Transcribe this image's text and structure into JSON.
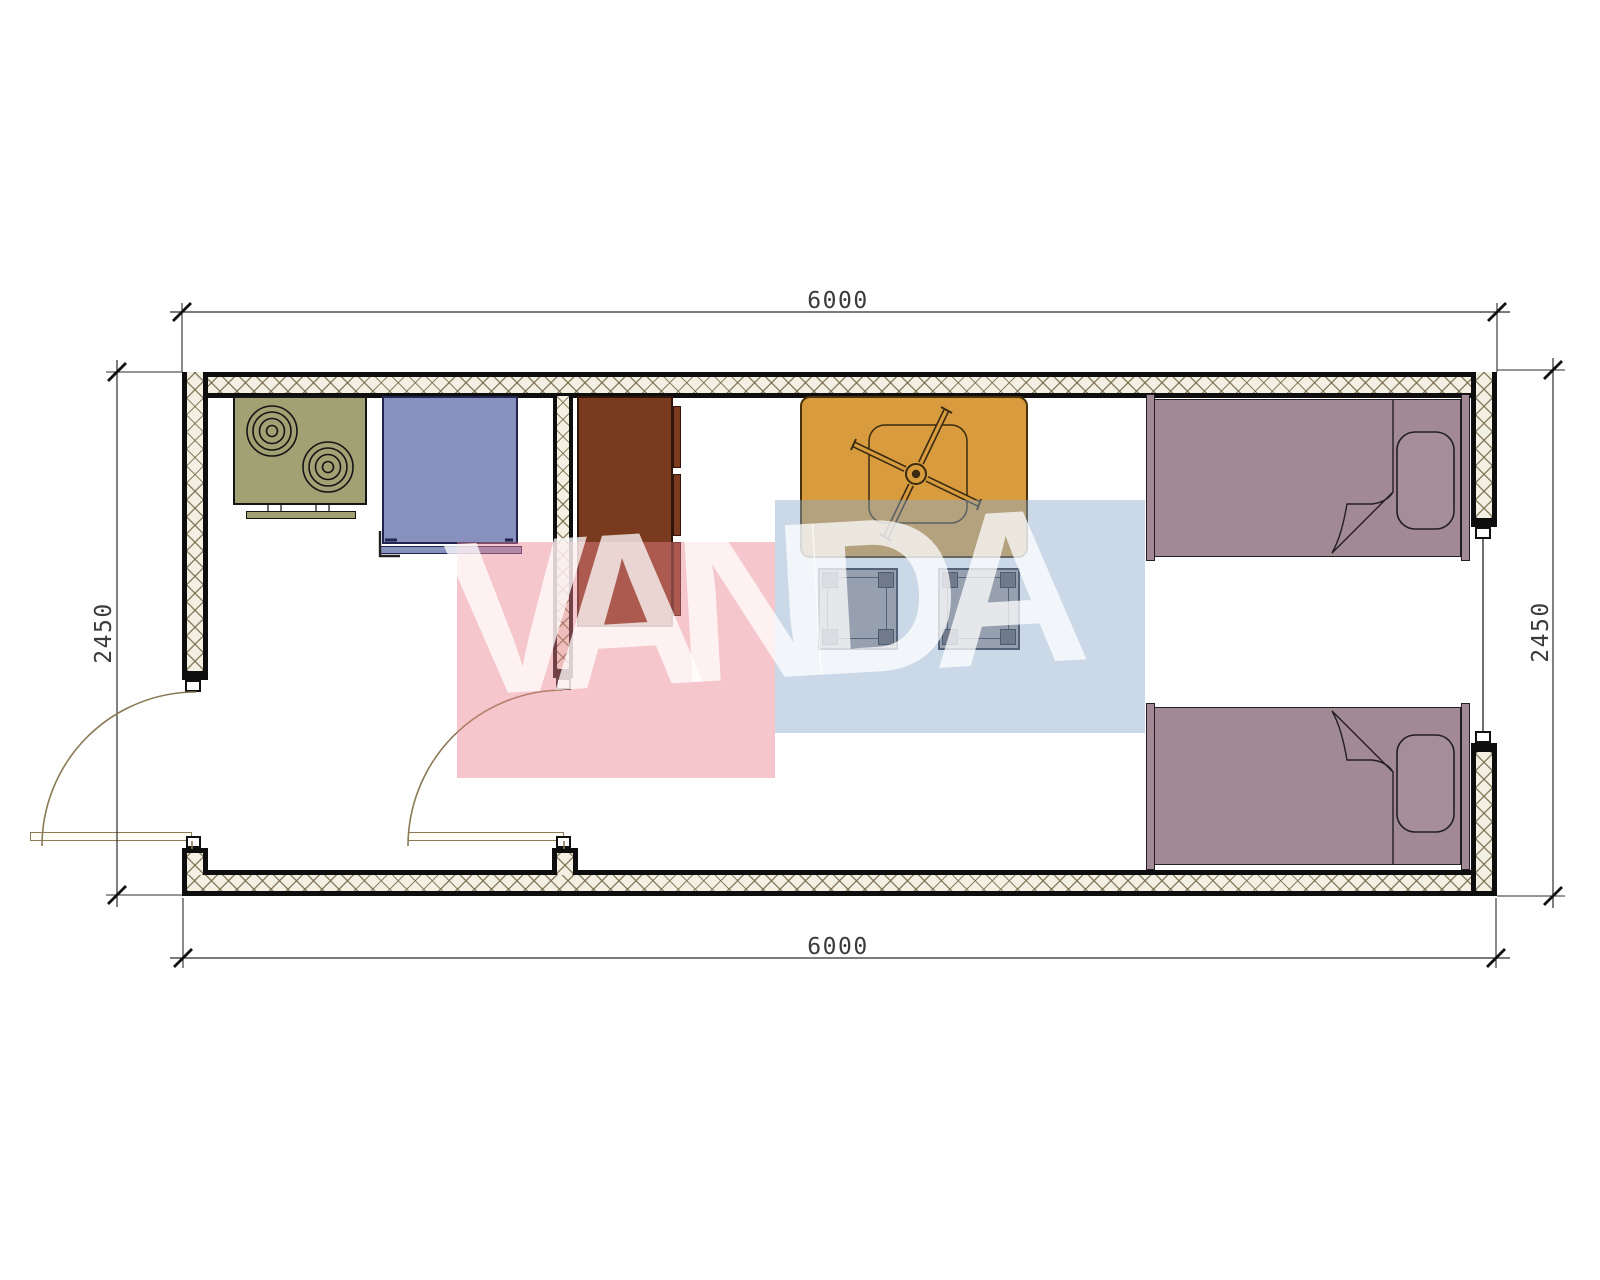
{
  "drawing": {
    "type": "container-house floor plan",
    "dimensions": {
      "top": "6000",
      "bottom": "6000",
      "left": "2450",
      "right": "2450"
    },
    "watermark": {
      "text": "VANDA",
      "pink_color": "#E98291",
      "blue_color": "#8AA8CD"
    },
    "colors": {
      "wall_line": "#0e0e0e",
      "wall_hatch_bg": "#F3EFE2",
      "door_line": "#8a7a55",
      "stove": "#A1A174",
      "appliance": "#8691BE",
      "cabinet": "#7A3A1D",
      "table": "#D89C3E",
      "stool": "#A09997",
      "bed": "#A28A94"
    },
    "furniture": [
      {
        "name": "stove",
        "room": "kitchen"
      },
      {
        "name": "appliance",
        "room": "kitchen"
      },
      {
        "name": "cabinet",
        "room": "living-room"
      },
      {
        "name": "dining-table-with-fan",
        "room": "living-room"
      },
      {
        "name": "stool",
        "count": 2
      },
      {
        "name": "single-bed",
        "count": 2
      }
    ]
  }
}
